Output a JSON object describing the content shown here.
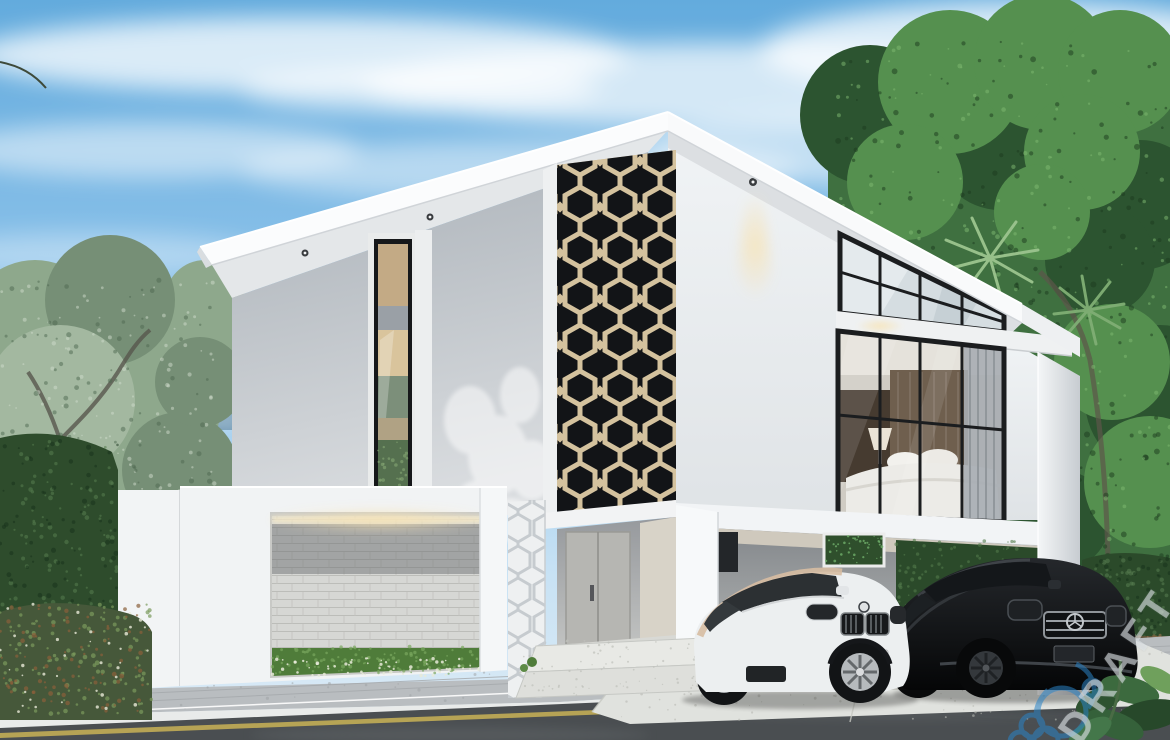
{
  "scene": {
    "type": "architectural-exterior-render",
    "description": "Modern two-storey white house with black geometric facade screen, carport with two cars, tropical garden, street in foreground",
    "watermark": {
      "text": "DRAFT"
    },
    "objects": [
      "blue sky with wispy clouds",
      "blue mountain ridge left",
      "sage green trees left",
      "dense tropical trees and palm fronds right",
      "dark green hedge walls",
      "white modern house",
      "black hexagonal perforated tower screen with warm backlight",
      "vertical window strip left wing",
      "glass gable wall with bedroom interior",
      "carport with white SUV and black sedan",
      "white front fence with stacked stone accent panel",
      "paver sidewalk, white curb, asphalt road with yellow line",
      "DRAFT watermark and blue logo watermark"
    ],
    "palette": {
      "sky_top": "#63abdd",
      "sky_bottom": "#ddebf6",
      "cloud": "#ffffff",
      "mountain": "#5d89a8",
      "foliage_left": "#8ea88c",
      "foliage_right": "#3f7040",
      "hedge_dark": "#2b4a2a",
      "wall_white": "#f4f6f7",
      "wall_shade": "#a9b0b7",
      "screen_black": "#121417",
      "screen_backlight": "#e8d7b2",
      "glass_mullion": "#1b1d1f",
      "stone_panel": "#d6d7d4",
      "grass": "#4f7c3a",
      "driveway": "#e0e2de",
      "paver": "#b9bdc0",
      "curb": "#e9ebea",
      "road": "#4a4e51",
      "road_line_yellow": "#c9b356",
      "car_bmw_white": "#eceff0",
      "car_bmw_roof_tint": "#d7bda2",
      "car_mercedes_black": "#0c0e10",
      "downlight_glow": "#f7e3b3",
      "watermark_gray": "#e4e9ec",
      "watermark_blue": "#2b84c6"
    }
  }
}
